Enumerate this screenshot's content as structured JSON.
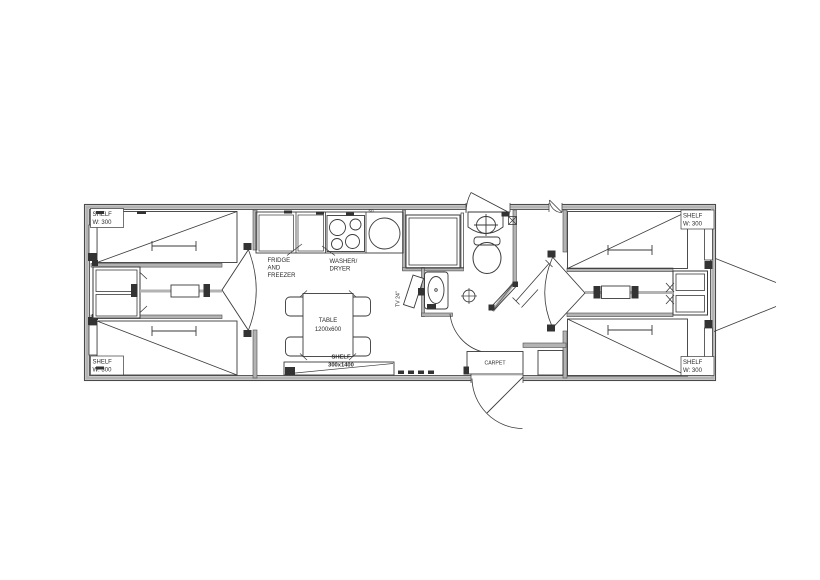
{
  "colors": {
    "background": "#ffffff",
    "line": "#3a3a3a",
    "wall_fill": "#b3b3b3",
    "wall_edge": "#4a4a4a",
    "text": "#2b2b2b"
  },
  "plan": {
    "type": "floor-plan",
    "labels": {
      "shelf_top_left": {
        "line1": "SHELF",
        "line2": "W: 300"
      },
      "shelf_bottom_left": {
        "line1": "SHELF",
        "line2": "W: 300"
      },
      "shelf_top_right": {
        "line1": "SHELF",
        "line2": "W: 300"
      },
      "shelf_bottom_right": {
        "line1": "SHELF",
        "line2": "W: 300"
      },
      "fridge": {
        "line1": "FRIDGE",
        "line2": "AND",
        "line3": "FREEZER"
      },
      "washer": {
        "line1": "WASHER/",
        "line2": "DRYER"
      },
      "table": {
        "line1": "TABLE",
        "line2": "1200x600"
      },
      "long_shelf": {
        "line1": "SHELF",
        "line2": "300x1400"
      },
      "tv": "TV 24\"",
      "carpet": "CARPET",
      "sink_dim": "50"
    }
  }
}
